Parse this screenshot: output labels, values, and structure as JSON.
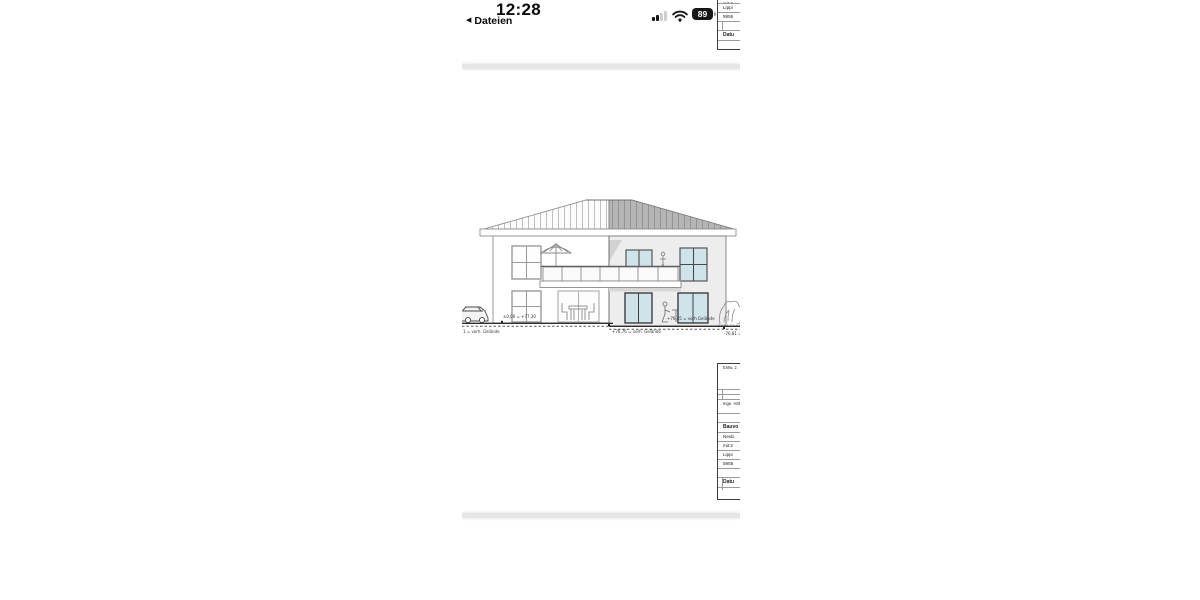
{
  "status_bar": {
    "time": "12:28",
    "back_icon": "◀",
    "back_label": "Dateien",
    "battery_percent": "89"
  },
  "colors": {
    "glazing": "#cfe3eb",
    "roof_gray": "#b5b5b5",
    "wall_gray": "#ededed",
    "battery_fill": "#17171a"
  },
  "drawing": {
    "annotations": {
      "left_level": "±0,00 = +77,30",
      "ground_left": "1 = vorh. Gelände",
      "ground_center": "+76,76 = vorh. Gelände",
      "right_level": "+76,45 = vorh.Gelände",
      "ground_right": "-76,81 ="
    }
  },
  "title_block_top": {
    "rows": [
      "mit 2",
      "Lippi",
      "5955",
      "",
      "Datu",
      ""
    ]
  },
  "title_block_main": {
    "rows_head": "Entw. J.",
    "rows": [
      "",
      "",
      "Inge. Höhe",
      "",
      "Bauvo",
      "Neub.",
      "mit 2",
      "Lippi",
      "5955",
      "",
      "Datu",
      ""
    ]
  }
}
